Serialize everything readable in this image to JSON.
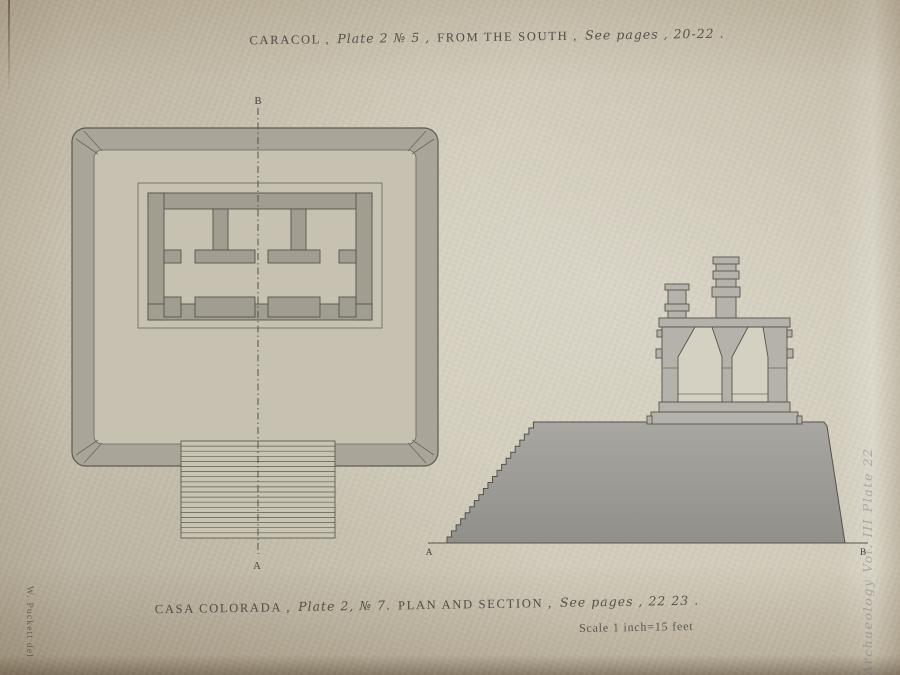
{
  "plate": {
    "top_caption": {
      "monument": "CARACOL ,",
      "plate_no": "Plate 2 № 5 ,",
      "view": "FROM THE SOUTH ,",
      "pages": "See pages , 20-22 ."
    },
    "bottom_caption": {
      "monument": "CASA COLORADA ,",
      "plate_no": "Plate 2, № 7.",
      "view": "PLAN AND SECTION ,",
      "pages": "See pages , 22 23 ."
    },
    "scale_note": "Scale 1 inch=15 feet",
    "artist_credit": "W. Puckett del",
    "pencil_annotation": "Archaeology Vol. III Plate 22"
  },
  "plan_drawing": {
    "section_line_top_label": "B",
    "section_line_bottom_label": "A"
  },
  "section_drawing": {
    "baseline_left_label": "A",
    "baseline_right_label": "B"
  },
  "palette": {
    "paper": "#d4cebd",
    "ink": "#4e4c45",
    "wash_light": "#b4b2aa",
    "wash_dark": "#a19d90",
    "pencil_gray": "#7a8090"
  }
}
